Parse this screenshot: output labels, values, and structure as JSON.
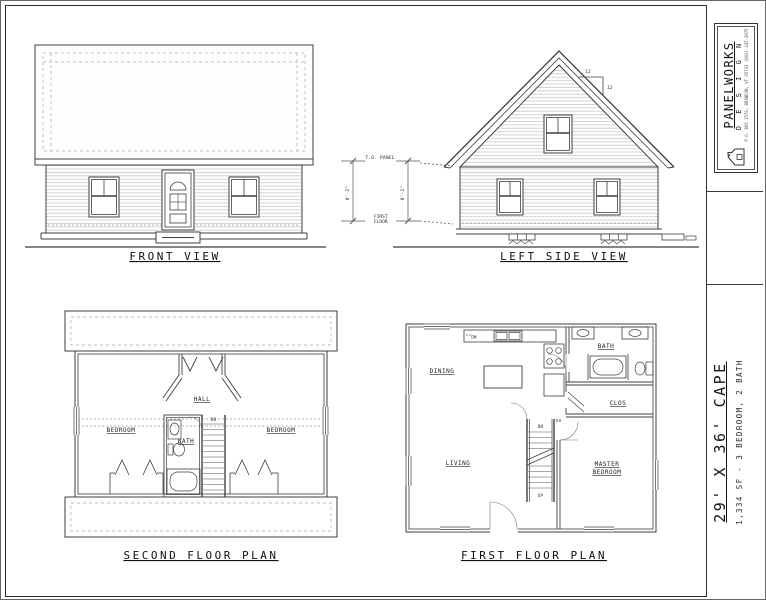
{
  "sheet": {
    "views": {
      "front": {
        "label": "FRONT VIEW"
      },
      "left_side": {
        "label": "LEFT SIDE VIEW",
        "pitch_rise": "12",
        "pitch_run": "12",
        "dim_top_of_panel": "T.O. PANEL",
        "dim_first_floor_line1": "FIRST",
        "dim_first_floor_line2": "FLOOR",
        "wall_height": "8'-2\""
      },
      "second_floor": {
        "label": "SECOND FLOOR PLAN",
        "rooms": {
          "hall": "HALL",
          "bath": "BATH",
          "bedroom_left": "BEDROOM",
          "bedroom_right": "BEDROOM"
        },
        "stair_down": "DN"
      },
      "first_floor": {
        "label": "FIRST FLOOR PLAN",
        "rooms": {
          "dining": "DINING",
          "living": "LIVING",
          "bath": "BATH",
          "closet": "CLOS",
          "master_line1": "MASTER",
          "master_line2": "BEDROOM"
        },
        "stair_down": "DN",
        "stair_up": "UP",
        "dishwasher": "DW"
      }
    },
    "title_block": {
      "company_name": "PANELWORKS",
      "company_tagline": "D E S I G N",
      "company_address": "P.O. BOX 1579, BRANDON, VT 05733 (802) 247-3975",
      "plan_name": "29' X 36' CAPE",
      "plan_stats": "1,334 SF - 3 BEDROOM, 2 BATH"
    },
    "colors": {
      "line": "#3f3f3f",
      "siding_line": "#c9c9c9",
      "dashed_line": "#9a9a9a",
      "text": "#141414",
      "background": "#ffffff"
    }
  }
}
